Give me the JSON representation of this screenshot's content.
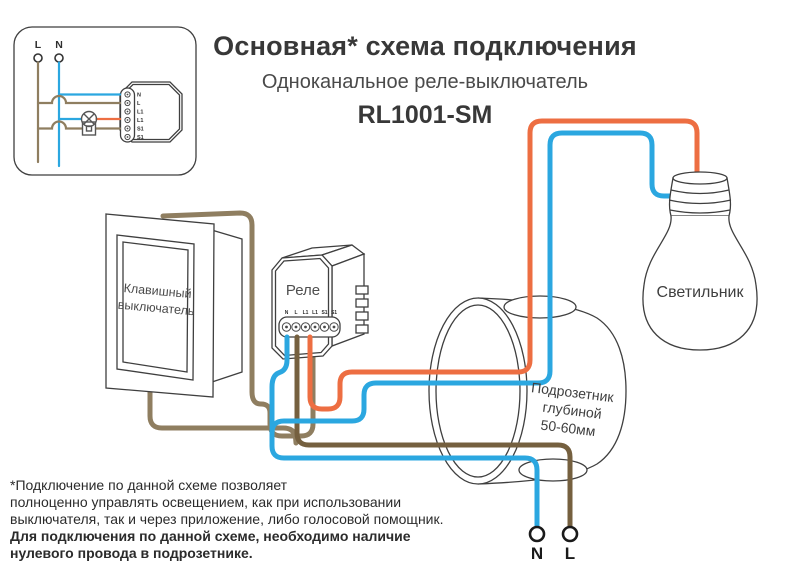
{
  "header": {
    "title": "Основная* схема подключения",
    "subtitle": "Одноканальное реле-выключатель",
    "model": "RL1001-SM"
  },
  "inset": {
    "terminal_left": "L",
    "terminal_right": "N",
    "relay_terminals": [
      "N",
      "L",
      "L1",
      "L1",
      "S1",
      "S1"
    ]
  },
  "diagram": {
    "switch_label_line1": "Клавишный",
    "switch_label_line2": "выключатель",
    "relay_label": "Реле",
    "relay_terminals": [
      "N",
      "L",
      "L1",
      "L1",
      "S1",
      "S1"
    ],
    "backbox_line1": "Подрозетник",
    "backbox_line2": "глубиной",
    "backbox_line3": "50-60мм",
    "bulb_label": "Светильник",
    "mains_n": "N",
    "mains_l": "L"
  },
  "footnote": {
    "line1": "*Подключение по данной схеме позволяет",
    "line2": "полноценно управлять освещением, как при использовании",
    "line3": "выключателя, так и через приложение, либо голосовой помощник.",
    "line4": "Для подключения по данной схеме, необходимо наличие",
    "line5": "нулевого провода в подрозетнике."
  },
  "colors": {
    "wire_blue": "#2BA7E0",
    "wire_orange": "#ED6E42",
    "wire_brown": "#75603F",
    "wire_tan": "#8F7E60",
    "outline": "#3F3F3F"
  }
}
